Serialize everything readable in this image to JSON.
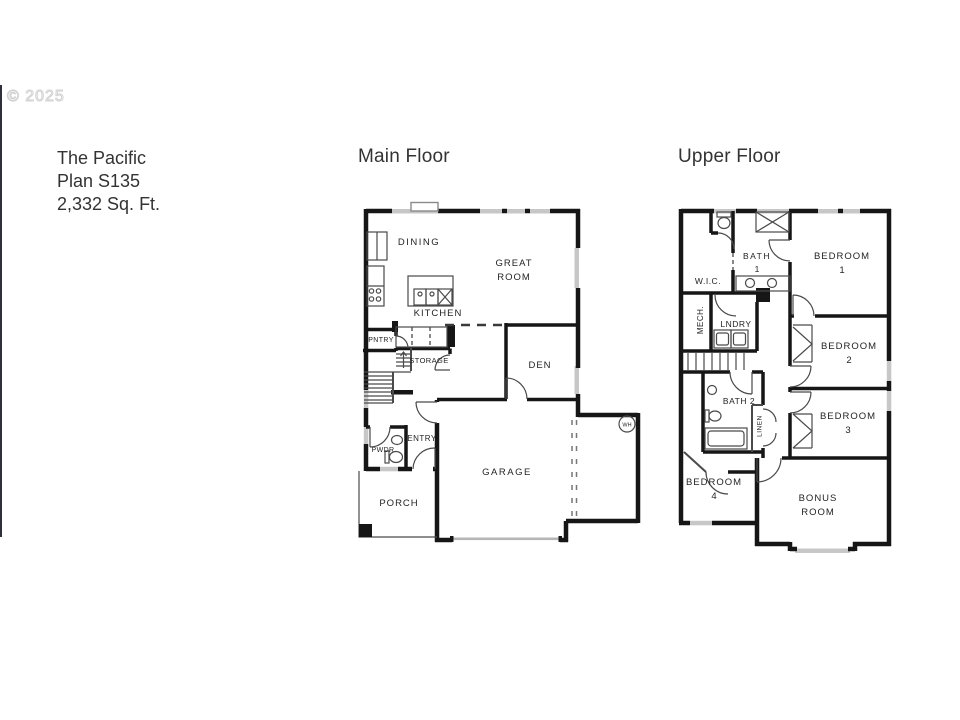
{
  "header": {
    "copyright": "© 2025",
    "title1": "The Pacific",
    "title2": "Plan S135",
    "title3": "2,332 Sq. Ft."
  },
  "main": {
    "heading": "Main Floor",
    "dining": "DINING",
    "great1": "GREAT",
    "great2": "ROOM",
    "kitchen": "KITCHEN",
    "pntry": "PNTRY",
    "storage": "STORAGE",
    "den": "DEN",
    "entry": "ENTRY",
    "pwdr": "PWDR",
    "porch": "PORCH",
    "garage": "GARAGE",
    "wh": "WH"
  },
  "upper": {
    "heading": "Upper Floor",
    "wic": "W.I.C.",
    "bath1a": "BATH",
    "bath1b": "1",
    "bed1a": "BEDROOM",
    "bed1b": "1",
    "mech": "MECH.",
    "lndry": "LNDRY",
    "bed2a": "BEDROOM",
    "bed2b": "2",
    "bath2": "BATH 2",
    "linen": "LINEN",
    "bed3a": "BEDROOM",
    "bed3b": "3",
    "bed4a": "BEDROOM",
    "bed4b": "4",
    "bonusa": "BONUS",
    "bonusb": "ROOM"
  },
  "colors": {
    "wall": "#161616",
    "window": "#c7c7c7",
    "edge_line": "#30303a",
    "text": "#333333"
  }
}
